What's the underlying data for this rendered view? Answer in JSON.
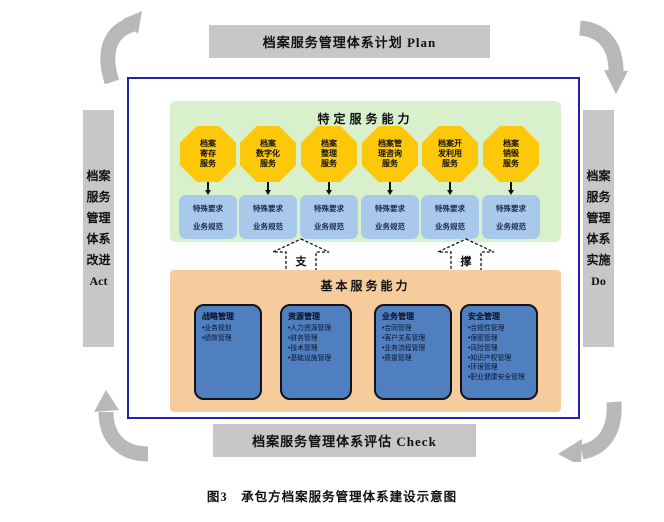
{
  "pdca": {
    "plan": "档案服务管理体系计划 Plan",
    "do": "档案\n服务\n管理\n体系\n实施\nDo",
    "check": "档案服务管理体系评估 Check",
    "act": "档案\n服务\n管理\n体系\n改进\nAct"
  },
  "specific": {
    "title": "特定服务能力",
    "box_line1": "特殊要求",
    "box_line2": "业务规范",
    "services": [
      {
        "label": "档案\n寄存\n服务"
      },
      {
        "label": "档案\n数字化\n服务"
      },
      {
        "label": "档案\n整理\n服务"
      },
      {
        "label": "档案管\n理咨询\n服务"
      },
      {
        "label": "档案开\n发利用\n服务"
      },
      {
        "label": "档案\n销毁\n服务"
      }
    ]
  },
  "support": {
    "left": "支",
    "right": "撑"
  },
  "basic": {
    "title": "基本服务能力",
    "groups": [
      {
        "title": "战略管理",
        "items": [
          "业务规划",
          "绩效管理"
        ]
      },
      {
        "title": "资源管理",
        "items": [
          "人力资源管理",
          "财务管理",
          "技术管理",
          "基础设施管理"
        ]
      },
      {
        "title": "业务管理",
        "items": [
          "合同管理",
          "客户关系管理",
          "业务流程管理",
          "质量管理"
        ]
      },
      {
        "title": "安全管理",
        "items": [
          "合规性管理",
          "保密管理",
          "风险管理",
          "知识产权管理",
          "环境管理",
          "职业健康安全管理"
        ]
      }
    ]
  },
  "caption": "图3　承包方档案服务管理体系建设示意图",
  "colors": {
    "bar_gray": "#c7c7c7",
    "border_blue": "#2222b0",
    "panel_green": "#d8f0cb",
    "octagon_yellow": "#fec80a",
    "requirement_box_blue": "#a9c9ea",
    "panel_orange": "#f6cc9d",
    "group_box_blue": "#4f7fbe",
    "cycle_arrow_gray": "#b8b8b8"
  }
}
